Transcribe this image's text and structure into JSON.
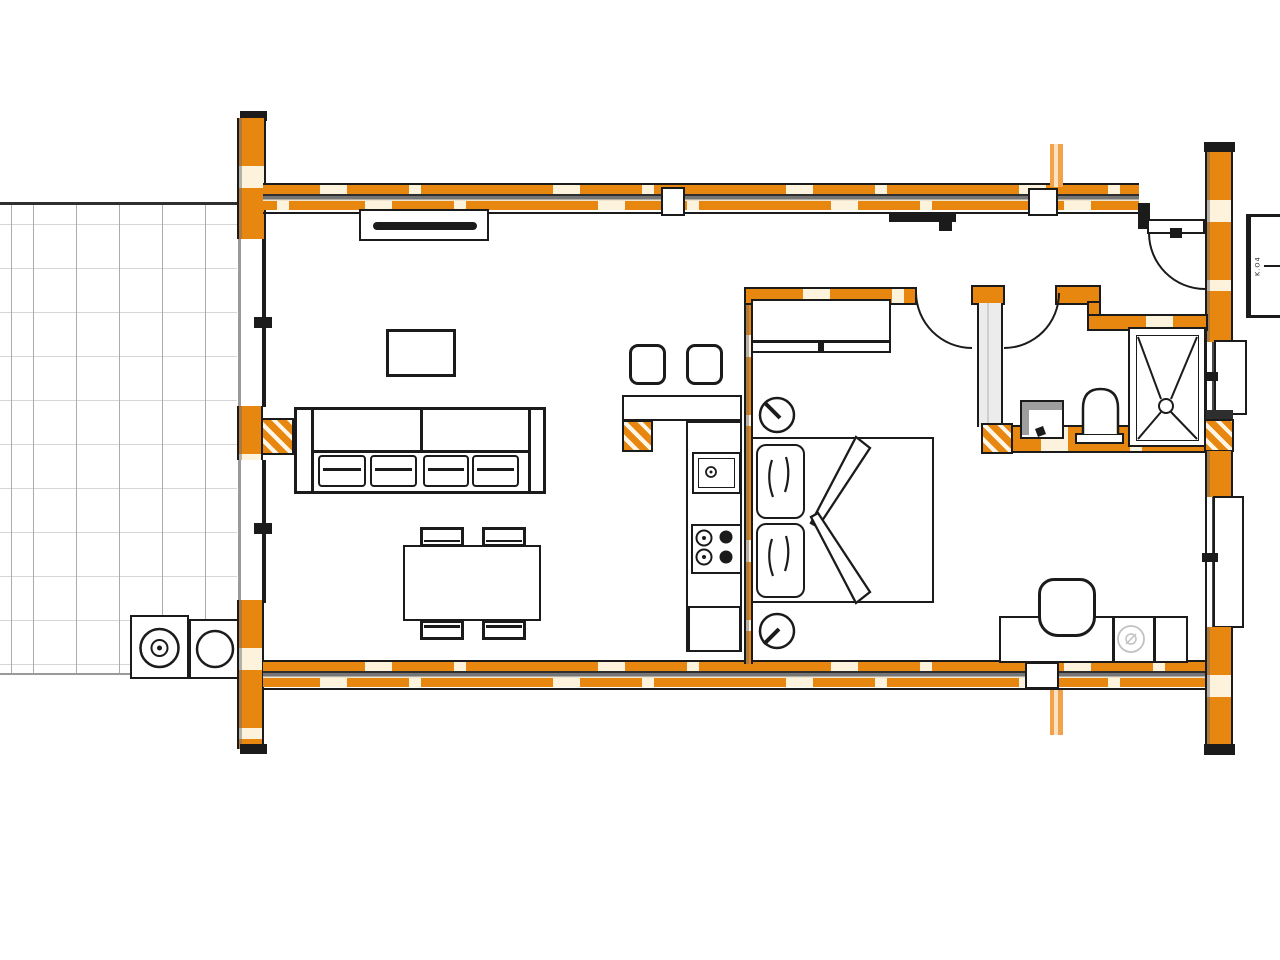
{
  "document": {
    "kind": "architectural floor plan",
    "view": "top-down plan of a one-bedroom log house with tiled terrace",
    "scale_text_visible": false
  },
  "colors": {
    "wall_orange": "#E8870F",
    "wall_highlight": "#FDF2DC",
    "wall_core": "#757575",
    "ink": "#1B1B1B",
    "grid_v": "#ABABAB",
    "grid_h": "#D6D6D6",
    "section_orange": "#F1A24B",
    "faint": "#C2C2C2",
    "shadow_gray": "#9E9E9E"
  },
  "legend_box": {
    "side_label": "K.O4"
  },
  "rooms": [
    {
      "name": "Terrace"
    },
    {
      "name": "Living room"
    },
    {
      "name": "Kitchen"
    },
    {
      "name": "Bedroom"
    },
    {
      "name": "Bathroom"
    },
    {
      "name": "Entrance hall"
    }
  ],
  "furniture": {
    "terrace": [
      "tiled floor grid",
      "outdoor grill / stove unit with two burner circles"
    ],
    "living_room": [
      "radiator under top wall",
      "coffee table",
      "sofa with four seat cushions",
      "dining table",
      "four dining chairs"
    ],
    "kitchen": [
      "two bar stools",
      "breakfast counter",
      "sink with drain",
      "four-burner cooktop",
      "base cabinet",
      "hatched post"
    ],
    "bedroom": [
      "wardrobe with sliding door",
      "double bed",
      "two pillows",
      "folded duvet",
      "two round bedside lamps"
    ],
    "bathroom": [
      "washbasin with tap",
      "toilet",
      "shower tray with cross drain lines"
    ],
    "entrance_hall": [
      "entrance door with swing arc",
      "coat rack bar",
      "desk / sideboard",
      "desk chair",
      "faint appliance circle"
    ]
  },
  "doors": [
    "entrance door (top right)",
    "bedroom door",
    "bathroom door"
  ],
  "windows": [
    "left glazed wall upper section",
    "left glazed wall lower section",
    "right wall window upper",
    "right wall window lower"
  ],
  "section_marks": [
    "orange section line above top wall",
    "orange section line below bottom wall"
  ]
}
